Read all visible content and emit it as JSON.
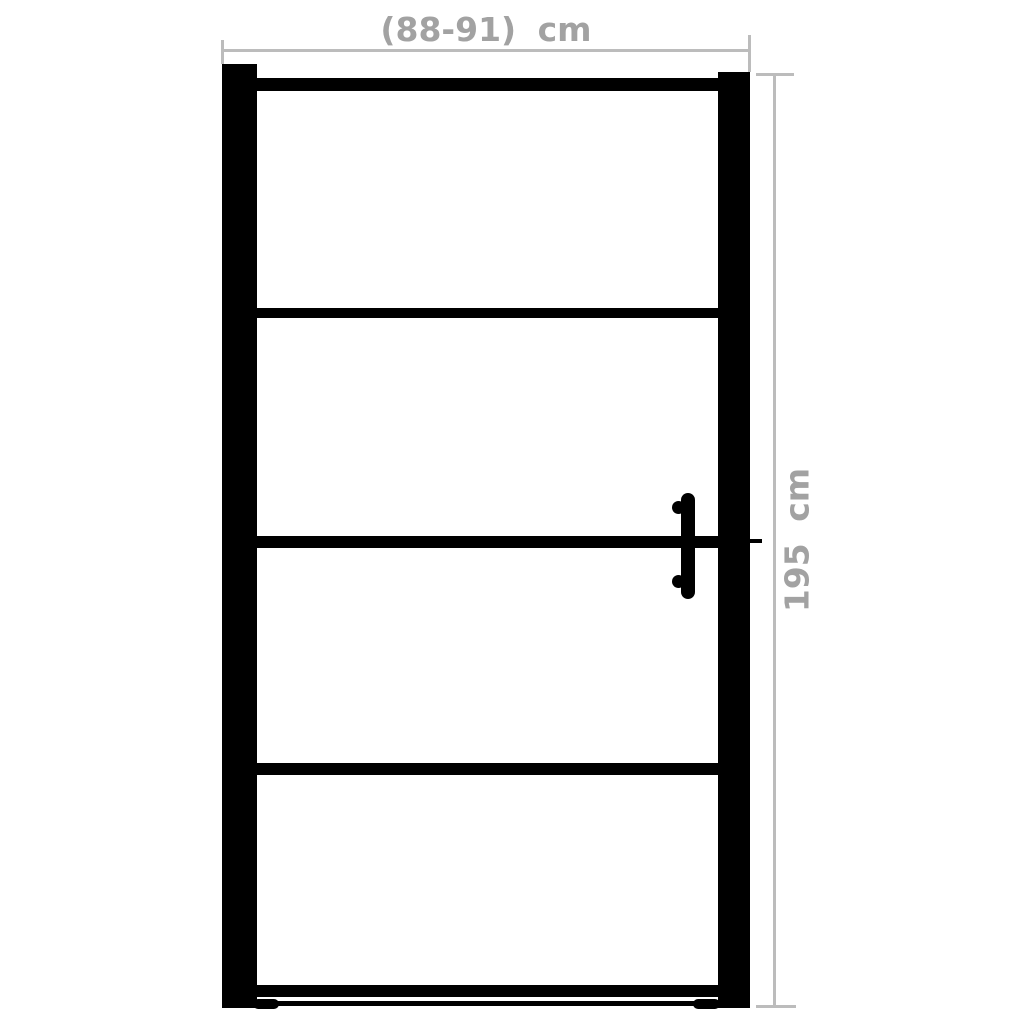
{
  "diagram": {
    "type": "product-dimension-diagram",
    "subject": "black-framed glass door with four horizontal panels and a vertical grip handle, front view",
    "panel_count": 4,
    "width_dimension": {
      "label": "(88-91) cm",
      "min_cm": 88,
      "max_cm": 91
    },
    "height_dimension": {
      "label": "195 cm",
      "value_cm": 195
    },
    "colors": {
      "frame": "#000000",
      "dimension_line": "#bcbcbc",
      "dimension_text": "#a2a2a2",
      "background": "#ffffff"
    }
  }
}
